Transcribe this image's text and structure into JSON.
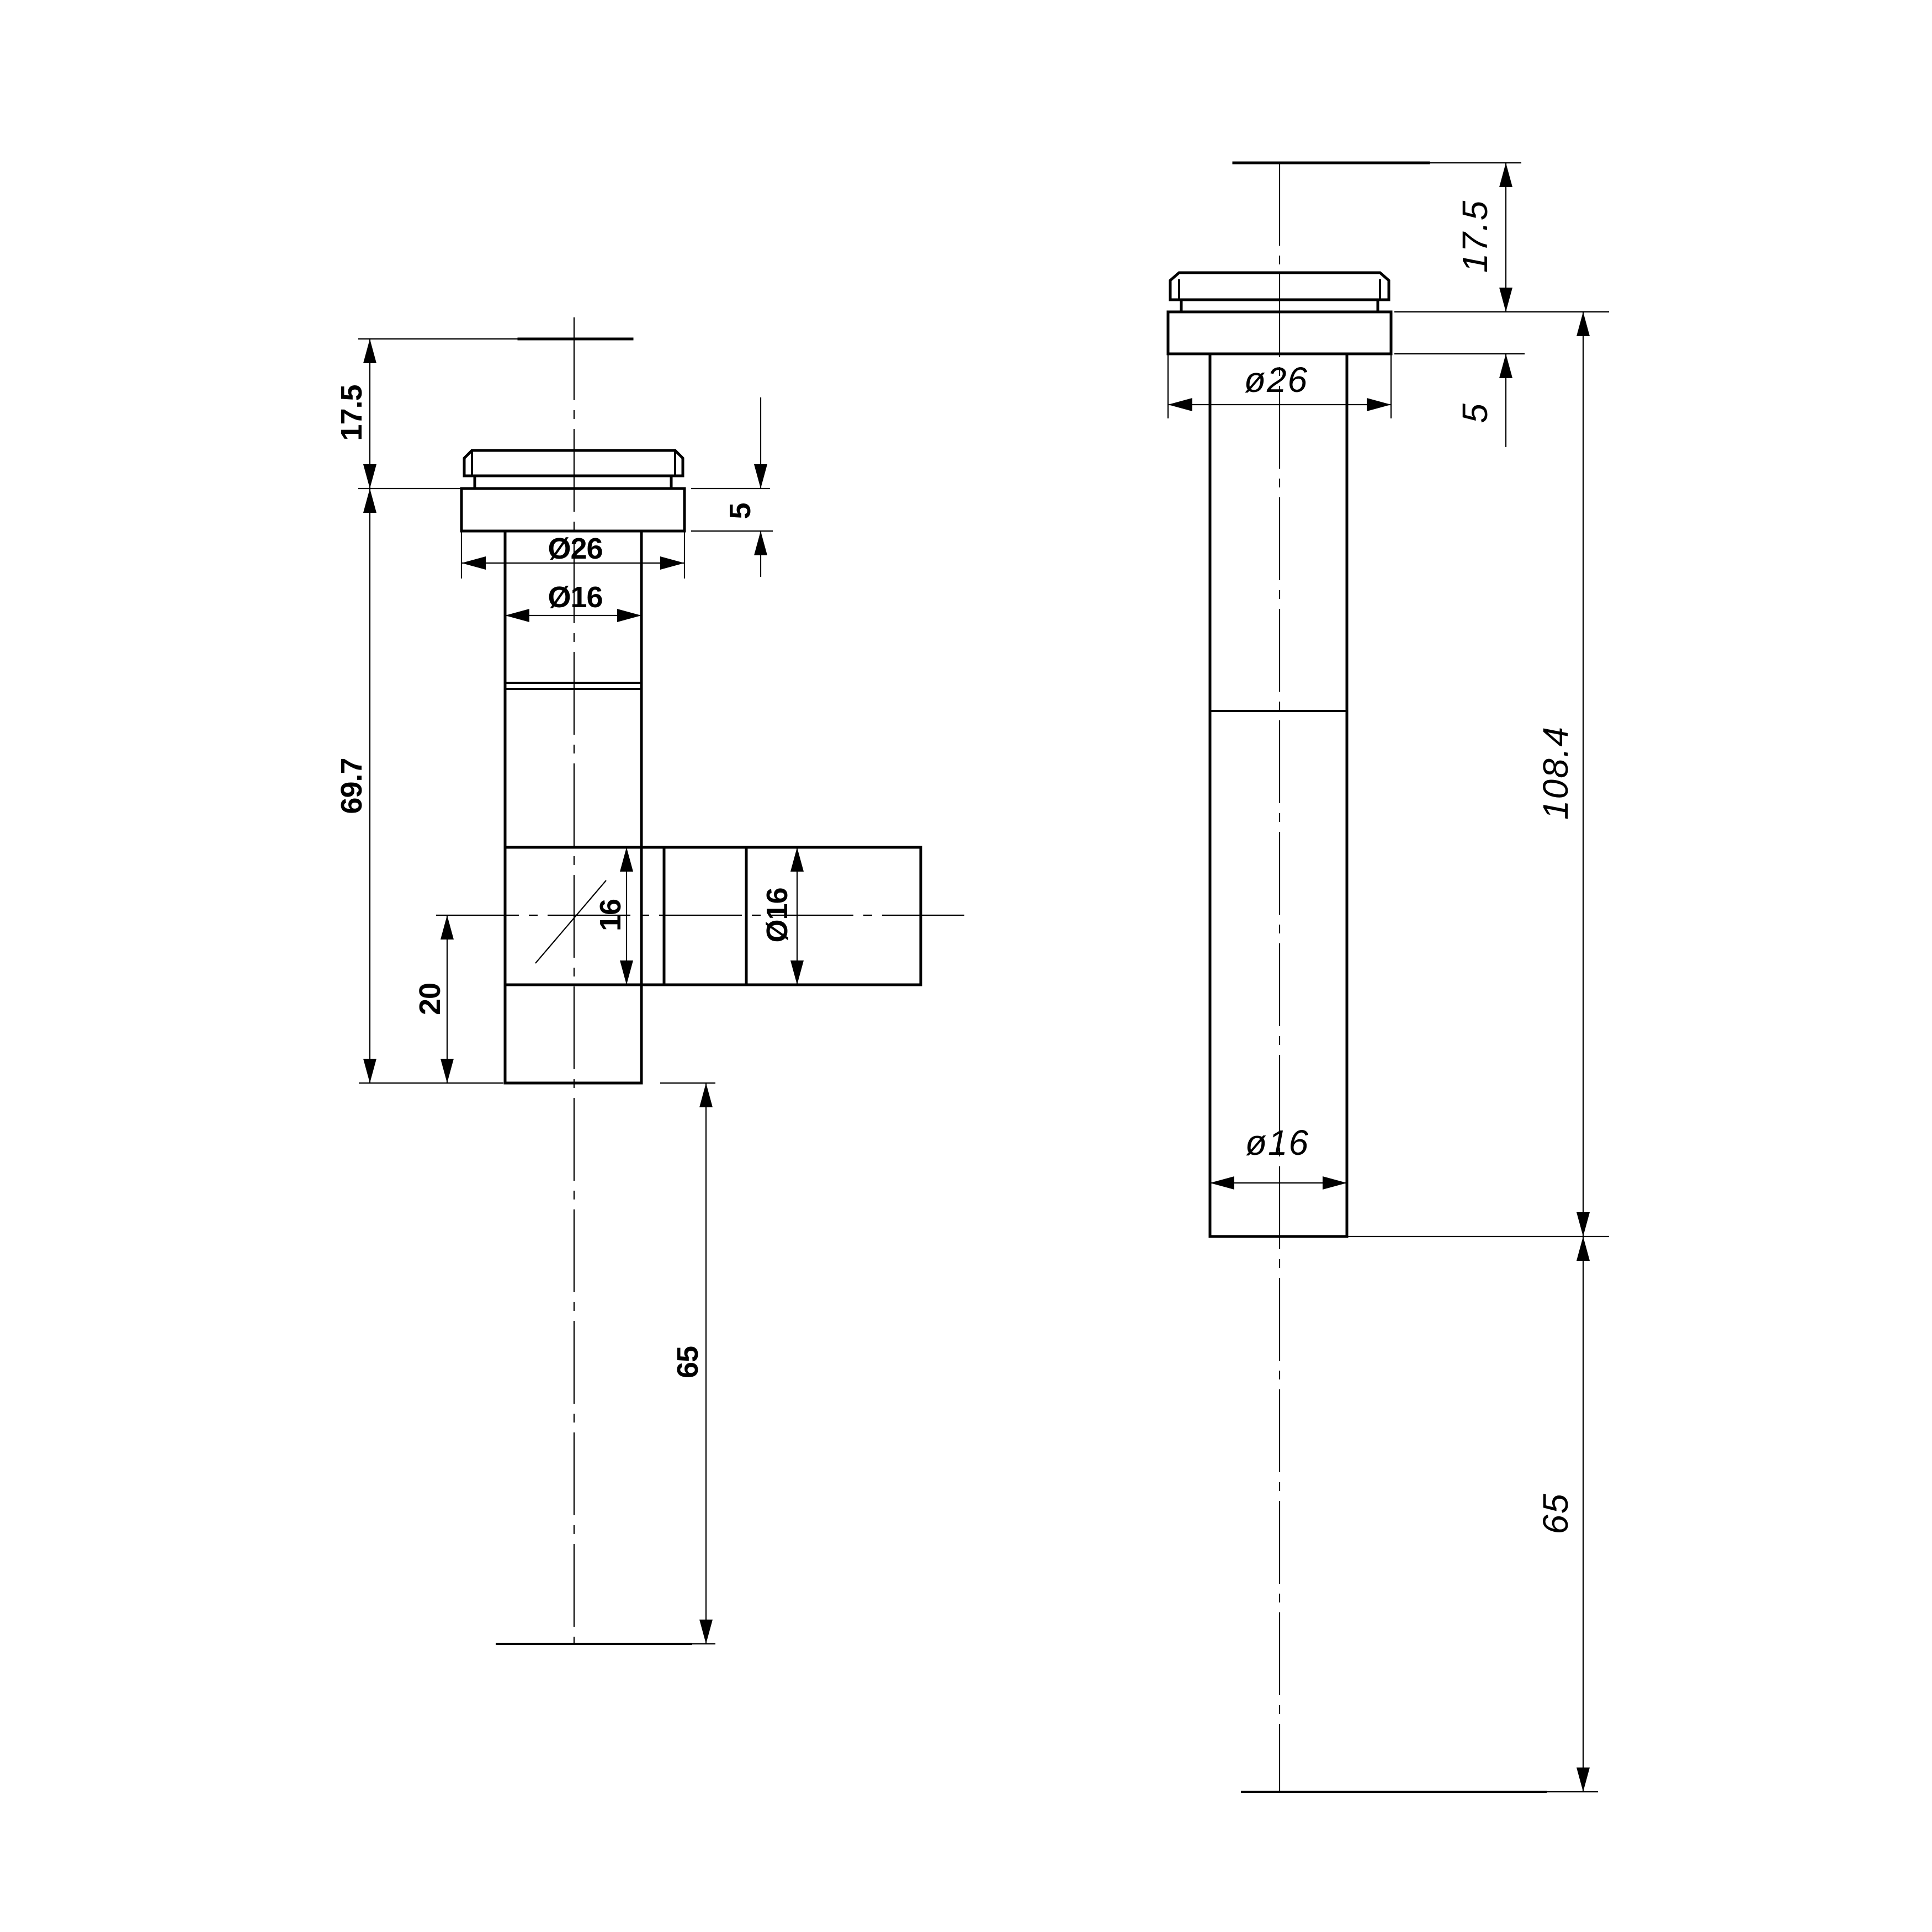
{
  "front": {
    "d17_5": "17.5",
    "d69_7": "69.7",
    "d20": "20",
    "d65": "65",
    "d5": "5",
    "dia26": "Ø26",
    "dia16": "Ø16",
    "d16": "16",
    "dia16_branch": "Ø16"
  },
  "side": {
    "d17_5": "17.5",
    "d5": "5",
    "dia26": "ø26",
    "d108_4": "108.4",
    "dia16": "ø16",
    "d65": "65"
  },
  "colors": {
    "ink": "#000000",
    "paper": "#ffffff"
  }
}
